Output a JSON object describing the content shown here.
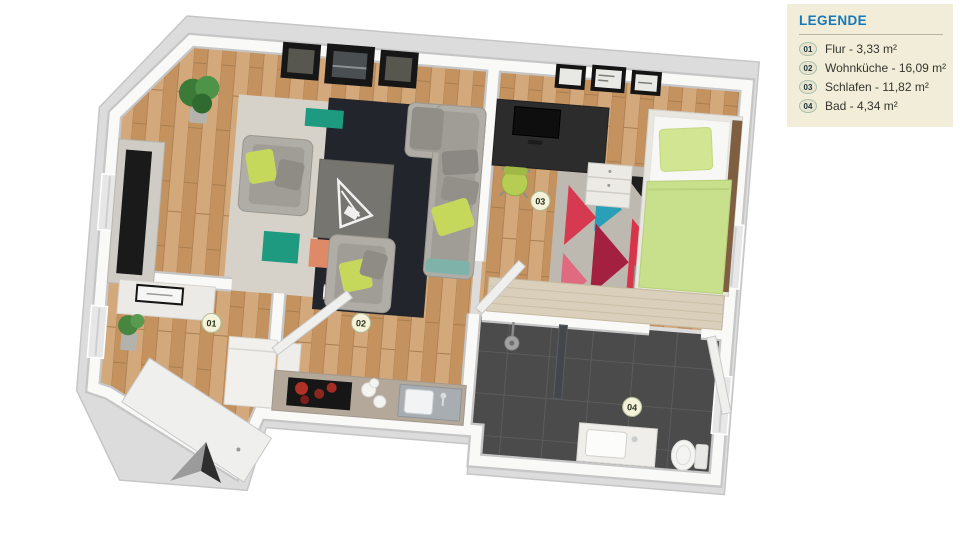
{
  "legend": {
    "title": "LEGENDE",
    "items": [
      {
        "num": "01",
        "label": "Flur - 3,33 m²"
      },
      {
        "num": "02",
        "label": "Wohnküche - 16,09 m²"
      },
      {
        "num": "03",
        "label": "Schlafen - 11,82 m²"
      },
      {
        "num": "04",
        "label": "Bad - 4,34 m²"
      }
    ]
  },
  "plan": {
    "markers": [
      {
        "num": "01"
      },
      {
        "num": "02"
      },
      {
        "num": "03"
      },
      {
        "num": "04"
      }
    ]
  },
  "colors": {
    "legend_bg": "#f1edd9",
    "legend_title": "#1878b8",
    "wood_floor": "#c99c6e",
    "bath_tile": "#4b4b4b",
    "accent_green": "#c3d653"
  }
}
